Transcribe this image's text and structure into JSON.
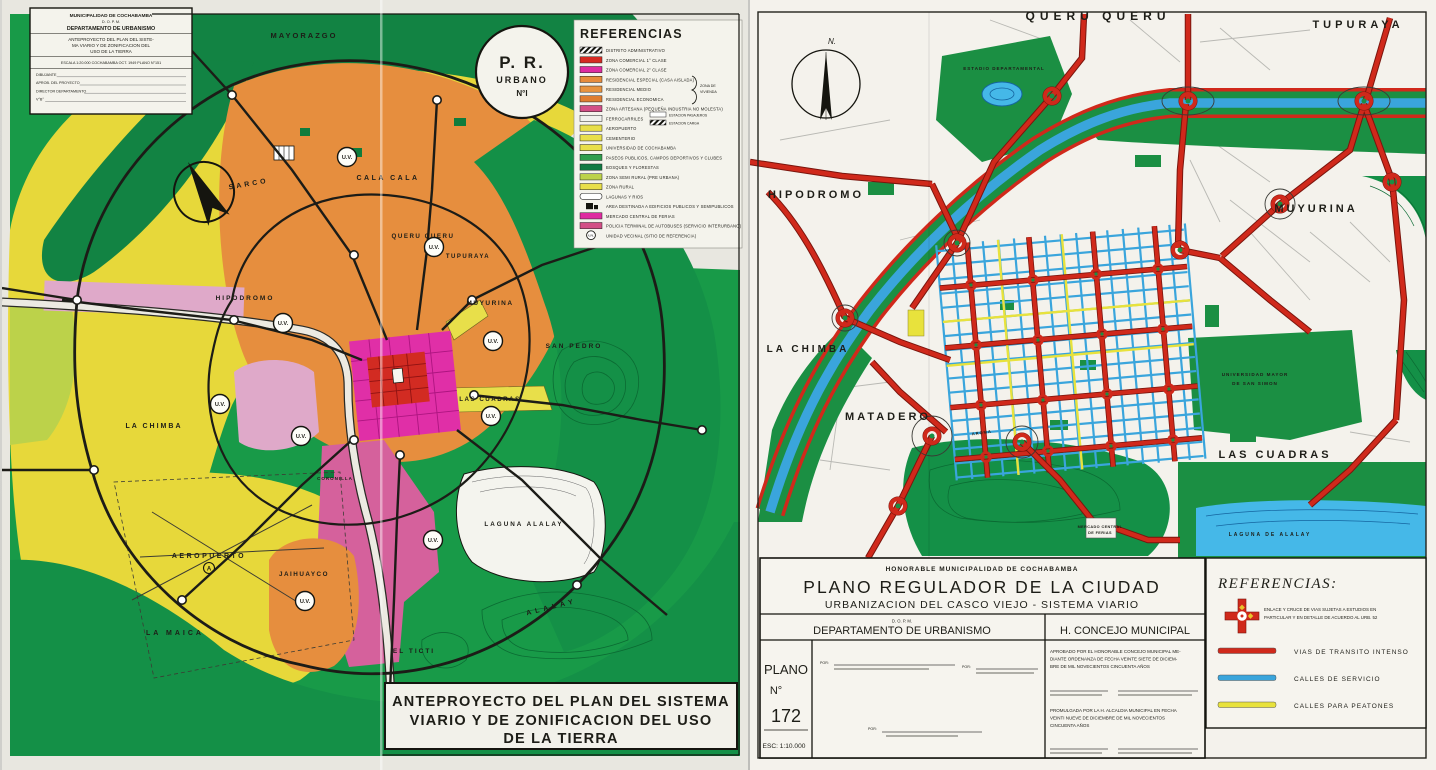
{
  "left_sheet": {
    "info_box": {
      "muni": "MUNICIPALIDAD DE COCHABAMBA",
      "dept_abbr": "D. O. P. M.",
      "dept": "DEPARTAMENTO DE URBANISMO",
      "subject_l1": "ANTEPROYECTO DEL PLAN DEL SISTE-",
      "subject_l2": "MA VIARIO Y DE ZONIFICACION DEL",
      "subject_l3": "USO DE LA TIERRA",
      "scale_line": "ESCALA 1:20.000   COCHABAMBA OCT. 1949   PLANO N°151",
      "fields": [
        {
          "label": "DIBUJANTE"
        },
        {
          "label": "APROB. DEL PROYECTO"
        },
        {
          "label": "DIRECTOR DEPARTAMENTO"
        },
        {
          "label": "V°B°"
        }
      ]
    },
    "stamp": {
      "l1": "P. R.",
      "l2": "URBANO",
      "l3": "N°I"
    },
    "legend": {
      "title": "REFERENCIAS",
      "bracket_l1": "ZONA DE",
      "bracket_l2": "VIVIENDA",
      "sub_items": [
        "ESTACION PASAJEROS",
        "ESTACION CARGA"
      ],
      "items": [
        {
          "c": "hatch",
          "t": "DISTRITO ADMINISTRATIVO"
        },
        {
          "c": "#d62a22",
          "t": "ZONA COMERCIAL 1° CLASE"
        },
        {
          "c": "#df2ba0",
          "t": "ZONA COMERCIAL 2° CLASE"
        },
        {
          "c": "#e78b3c",
          "t": "RESIDENCIAL ESPECIAL (CASA AISLADA)"
        },
        {
          "c": "#e8933f",
          "t": "RESIDENCIAL MEDIO"
        },
        {
          "c": "#df7d30",
          "t": "RESIDENCIAL ECONOMICA"
        },
        {
          "c": "#d34f86",
          "t": "ZONA ARTESANA (PEQUEÑA INDUSTRIA NO MOLESTA)"
        },
        {
          "c": "#f2f2ee",
          "t": "FERROCARRILES"
        },
        {
          "c": "#e8df4a",
          "t": "AEROPUERTO"
        },
        {
          "c": "#e8df4a",
          "t": "CEMENTERIO"
        },
        {
          "c": "#e8df4a",
          "t": "UNIVERSIDAD DE COCHABAMBA"
        },
        {
          "c": "#2f9e4d",
          "t": "PASEOS PUBLICOS, CAMPOS DEPORTIVOS Y CLUBES"
        },
        {
          "c": "#117a43",
          "t": "BOSQUES Y FLORESTAS"
        },
        {
          "c": "#bcd24a",
          "t": "ZONA SEMI RURAL (PRE URBANA)"
        },
        {
          "c": "#e8df4a",
          "t": "ZONA RURAL"
        },
        {
          "c": "lake",
          "t": "LAGUNAS Y RIOS"
        },
        {
          "c": "icon",
          "t": "AREA DESTINADA A EDIFICIOS PUBLICOS Y SEMIPUBLICOS"
        },
        {
          "c": "#df2ba0",
          "t": "MERCADO CENTRAL DE FERIAS"
        },
        {
          "c": "#d34f86",
          "t": "POLICIA TERMINAL DE AUTOBUSES (SERVICIO INTERURBANO)"
        },
        {
          "c": "uv",
          "t": "UNIDAD VECINAL (SITIO DE REFERENCIA)"
        }
      ]
    },
    "title_box": {
      "l1": "ANTEPROYECTO DEL PLAN DEL SISTEMA",
      "l2": "VIARIO Y DE ZONIFICACION DEL USO",
      "l3": "DE LA TIERRA"
    },
    "uv_text": "U.V.",
    "airport_marker": "A",
    "labels": [
      {
        "t": "MAYORAZGO",
        "x": 302,
        "y": 38,
        "s": 7.5,
        "ls": 2
      },
      {
        "t": "SARCO",
        "x": 247,
        "y": 186,
        "s": 7,
        "ls": 3,
        "r": -10
      },
      {
        "t": "CALA CALA",
        "x": 386,
        "y": 180,
        "s": 7,
        "ls": 2.5
      },
      {
        "t": "QUERU QUERU",
        "x": 421,
        "y": 238,
        "s": 6.2,
        "ls": 1.5
      },
      {
        "t": "TUPURAYA",
        "x": 466,
        "y": 258,
        "s": 6,
        "ls": 1.5
      },
      {
        "t": "HIPODROMO",
        "x": 243,
        "y": 300,
        "s": 6.5,
        "ls": 2
      },
      {
        "t": "MUYURINA",
        "x": 488,
        "y": 305,
        "s": 6.5,
        "ls": 1.5
      },
      {
        "t": "SAN PEDRO",
        "x": 572,
        "y": 348,
        "s": 6.5,
        "ls": 2
      },
      {
        "t": "LAS CUADRAS",
        "x": 488,
        "y": 401,
        "s": 6.2,
        "ls": 1.5
      },
      {
        "t": "LA CHIMBA",
        "x": 152,
        "y": 428,
        "s": 7,
        "ls": 2
      },
      {
        "t": "CORONILLA",
        "x": 333,
        "y": 480,
        "s": 4.5,
        "ls": 1
      },
      {
        "t": "LAGUNA ALALAY",
        "x": 522,
        "y": 526,
        "s": 6.3,
        "ls": 2
      },
      {
        "t": "AEROPUERTO",
        "x": 207,
        "y": 558,
        "s": 7,
        "ls": 2.5
      },
      {
        "t": "JAIHUAYCO",
        "x": 302,
        "y": 576,
        "s": 6.3,
        "ls": 1.5
      },
      {
        "t": "LA MAICA",
        "x": 173,
        "y": 635,
        "s": 7,
        "ls": 3
      },
      {
        "t": "EL TICTI",
        "x": 412,
        "y": 653,
        "s": 6.5,
        "ls": 2
      },
      {
        "t": "ALALAY",
        "x": 550,
        "y": 609,
        "s": 7,
        "ls": 4,
        "r": -14
      }
    ],
    "uv_markers": [
      {
        "x": 345,
        "y": 157
      },
      {
        "x": 432,
        "y": 247
      },
      {
        "x": 281,
        "y": 323
      },
      {
        "x": 491,
        "y": 341
      },
      {
        "x": 218,
        "y": 404
      },
      {
        "x": 299,
        "y": 436
      },
      {
        "x": 489,
        "y": 416
      },
      {
        "x": 431,
        "y": 540
      },
      {
        "x": 303,
        "y": 601
      }
    ]
  },
  "right_sheet": {
    "north_label": "N.",
    "labels": [
      {
        "t": "QUERU QUERU",
        "x": 348,
        "y": 20,
        "s": 12,
        "ls": 5
      },
      {
        "t": "TUPURAYA",
        "x": 608,
        "y": 28,
        "s": 11,
        "ls": 4
      },
      {
        "t": "HIPODROMO",
        "x": 66,
        "y": 198,
        "s": 11,
        "ls": 3
      },
      {
        "t": "LA CHIMBA",
        "x": 58,
        "y": 352,
        "s": 10,
        "ls": 3
      },
      {
        "t": "MATADERO",
        "x": 138,
        "y": 420,
        "s": 11,
        "ls": 3
      },
      {
        "t": "MUYURINA",
        "x": 566,
        "y": 212,
        "s": 11,
        "ls": 3
      },
      {
        "t": "LAS CUADRAS",
        "x": 525,
        "y": 458,
        "s": 11,
        "ls": 3
      },
      {
        "t": "ESTADIO DEPARTAMENTAL",
        "x": 254,
        "y": 70,
        "s": 4.5,
        "ls": 1
      },
      {
        "t": "UNIVERSIDAD MAYOR",
        "x": 505,
        "y": 376,
        "s": 4.6,
        "ls": 1
      },
      {
        "t": "DE SAN SIMON",
        "x": 505,
        "y": 385,
        "s": 4.6,
        "ls": 1
      },
      {
        "t": "LAGUNA DE ALALAY",
        "x": 520,
        "y": 536,
        "s": 5,
        "ls": 2
      },
      {
        "t": "MERCADO CENTRAL",
        "x": 350,
        "y": 528,
        "s": 3.8,
        "ls": 0.4
      },
      {
        "t": "DE FERIAS",
        "x": 350,
        "y": 534,
        "s": 3.8,
        "ls": 0.4
      },
      {
        "t": "AROMA",
        "x": 232,
        "y": 434,
        "s": 4,
        "ls": 1,
        "r": -8
      }
    ],
    "title_block": {
      "muni": "HONORABLE MUNICIPALIDAD DE COCHABAMBA",
      "title": "PLANO REGULADOR DE LA CIUDAD",
      "subtitle": "URBANIZACION DEL CASCO VIEJO - SISTEMA VIARIO",
      "dept_abbr": "D. O. P. M.",
      "dept": "DEPARTAMENTO DE URBANISMO",
      "council": "H. CONCEJO MUNICIPAL",
      "plano_word": "PLANO",
      "num_sign": "N°",
      "plano_num": "172",
      "scale": "ESC: 1:10.000",
      "sig_label": "POR:",
      "approved": [
        "APROBADO POR EL HONORABLE CONCEJO MUNICIPAL ME-",
        "DIANTE ORDENANZA DE FECHA VEINTE SIETE DE DICIEM-",
        "BRE DE MIL NOVECIENTOS CINCUENTA AÑOS"
      ],
      "promulgated": [
        "PROMULGADA POR LA H. ALCALDIA MUNICIPAL EN FECHA",
        "VEINTI NUEVE DE DICIEMBRE DE MIL NOVECIENTOS",
        "CINCUENTA AÑOS"
      ]
    },
    "legend": {
      "title": "REFERENCIAS:",
      "cross_note_l1": "ENLACE Y CRUCE DE VIAS SUJETAS A ESTUDIOS EN",
      "cross_note_l2": "PARTICULAR Y EN DETALLE DE ACUERDO AL URB. 52",
      "items": [
        {
          "c": "#d0291b",
          "t": "VIAS DE TRANSITO INTENSO"
        },
        {
          "c": "#3aa5dc",
          "t": "CALLES DE SERVICIO"
        },
        {
          "c": "#e8e23c",
          "t": "CALLES PARA PEATONES"
        }
      ]
    }
  },
  "colors": {
    "road_red": "#c8281c",
    "river_blue": "#3aa5dc",
    "park_green": "#1b8f43",
    "zoning_yellow": "#e7d83a",
    "zoning_orange": "#e68e3e",
    "zoning_magenta": "#e02fa7",
    "zoning_red": "#d22b22",
    "artisan_pink": "#d5619c"
  }
}
